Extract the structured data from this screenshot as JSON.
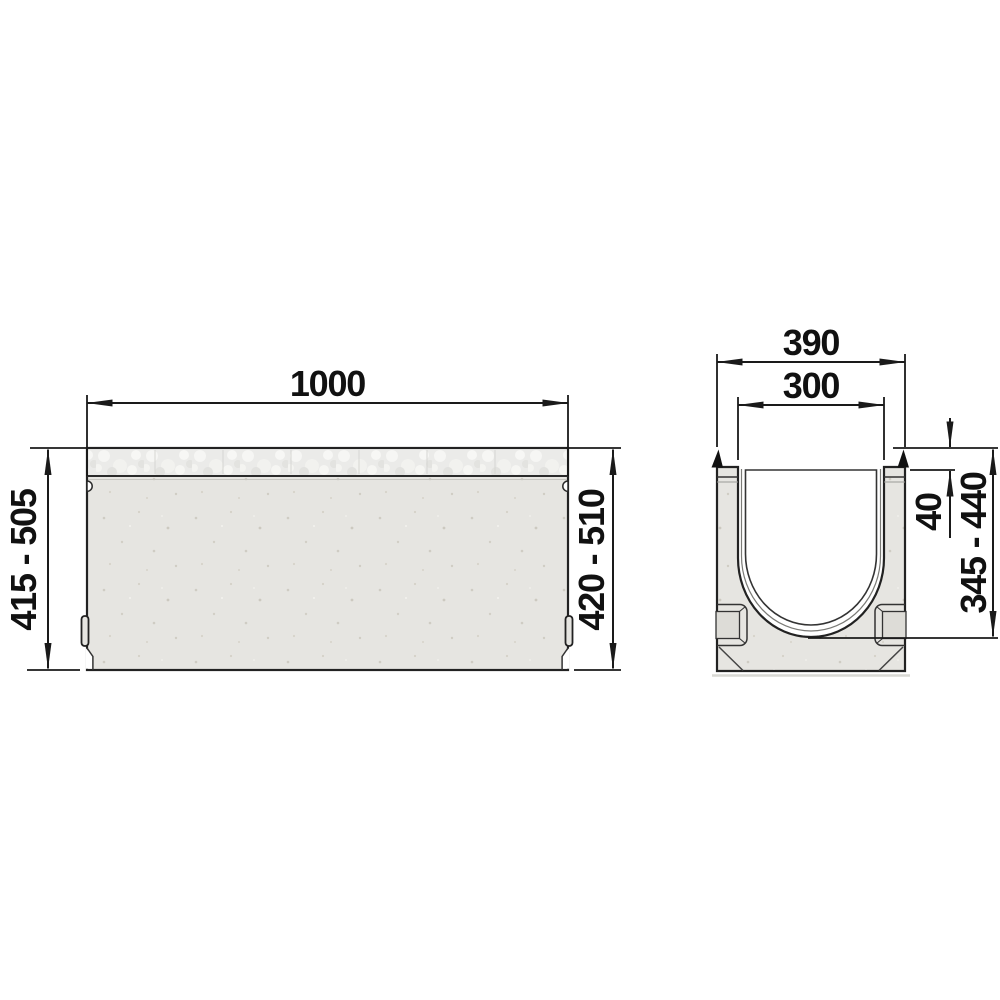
{
  "drawing": {
    "side_view": {
      "length_label": "1000",
      "height_left_label": "415 - 505",
      "height_right_label": "420 - 510"
    },
    "cross_section": {
      "outer_width_label": "390",
      "inner_width_label": "300",
      "edge_depth_label": "40",
      "height_label": "345 - 440"
    },
    "colors": {
      "line": "#1a1a1a",
      "concrete_fill": "#e6e5e1",
      "grate_strip_fill": "#ebebe9",
      "channel_interior": "#ffffff",
      "background": "#ffffff"
    }
  }
}
